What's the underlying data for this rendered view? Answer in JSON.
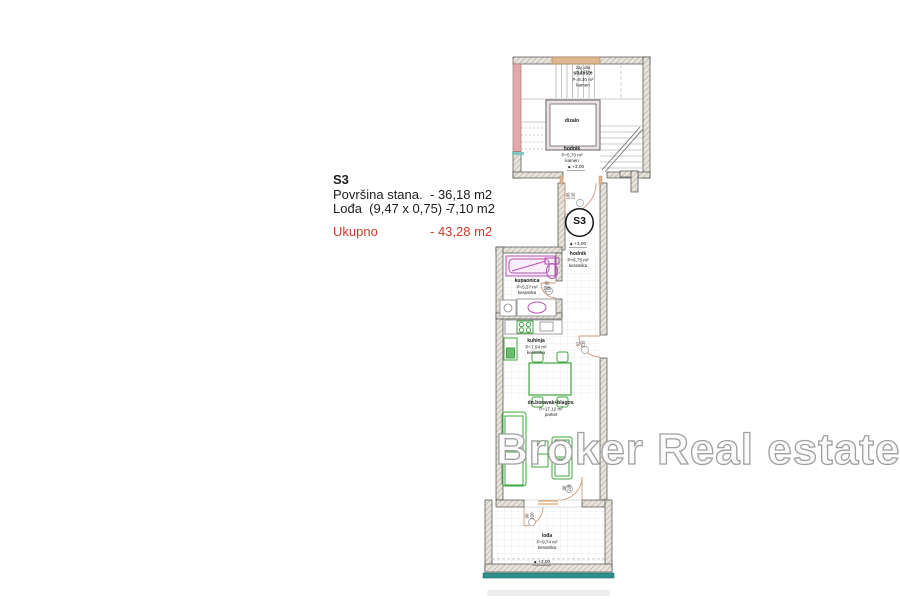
{
  "info_panel": {
    "unit": "S3",
    "row1_label": "Površina stana.",
    "row1_value": "- 36,18 m2",
    "row2_label": "Lođa  (9,47 x 0,75) -",
    "row2_value": "7,10 m2",
    "total_label": "Ukupno",
    "total_value": "- 43,28 m2"
  },
  "watermark_text": "Broker Real estate",
  "plan": {
    "unit_badge": "S3",
    "level_marker_glyph": "◆",
    "rooms": {
      "stubiste": {
        "line1": "zaj. dio",
        "name": "stubište",
        "area": "P=9,30 m²",
        "floor": "kamen"
      },
      "dizalo": {
        "name": "dizalo"
      },
      "hodnik_stubiste": {
        "name": "hodnik",
        "area": "P=5,70 m²",
        "floor": "kamen",
        "level": "+3,00"
      },
      "hodnik_stan": {
        "name": "hodnik",
        "area": "P=6,75 m²",
        "floor": "keramika",
        "level": "+3,00"
      },
      "kupaonica": {
        "name": "kupaonica",
        "area": "P=5,27 m²",
        "floor": "keramika"
      },
      "kuhinja": {
        "name": "kuhinja",
        "area": "P=7,04 m²",
        "floor": "keramika"
      },
      "boravak": {
        "name": "dn.boravak+blagov.",
        "area": "P=17,12 m²",
        "floor": "parket"
      },
      "lodja": {
        "name": "lođa",
        "area": "P=9,74 m²",
        "floor": "keramika",
        "level": "+3,00"
      }
    },
    "door_dims": {
      "entrance": [
        "105",
        "216"
      ],
      "kupaonica": [
        "82",
        "215"
      ],
      "kuhinja_lodja": [
        "92",
        "215"
      ],
      "boravak_lodja": [
        "90",
        "220"
      ],
      "lodja_side": [
        "90",
        "220"
      ]
    },
    "colors": {
      "wall_hatch": "#aaa49a",
      "wall_outline": "#4a4a4a",
      "existing_wall_pink": "#e2a9a9",
      "accent_orange": "#dfb68f",
      "sanitary_magenta": "#b650b6",
      "furniture_green": "#3fa63f",
      "parapet_teal": "#2f8f8a",
      "total_red": "#c9392c",
      "watermark_gray": "#a0a0a0"
    }
  }
}
